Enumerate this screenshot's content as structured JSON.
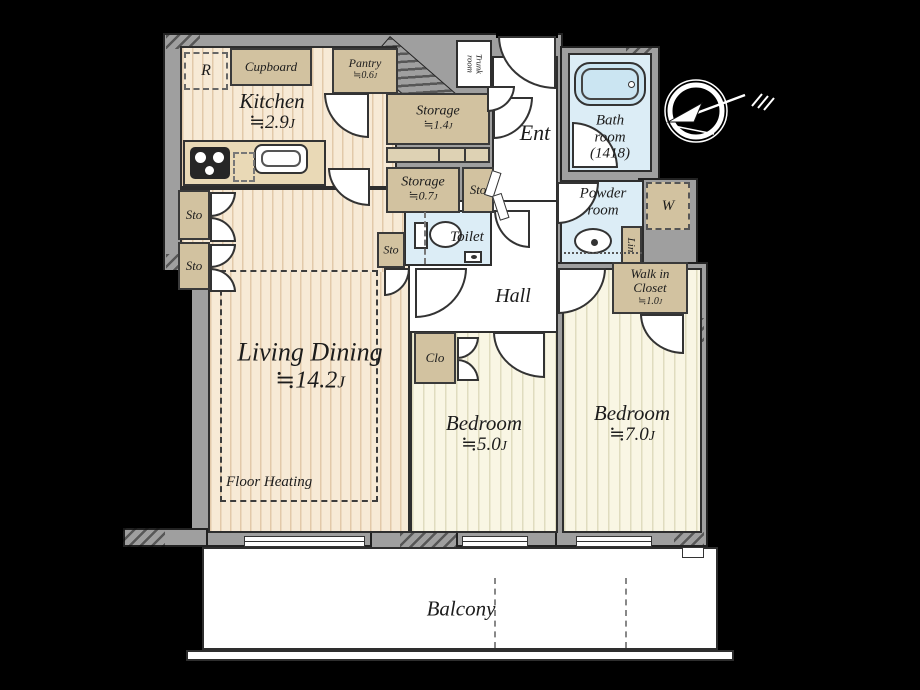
{
  "colors": {
    "background": "#000000",
    "wall": "#9f9f9f",
    "floor_warm": "#f7ead6",
    "floor_pale": "#f9f6e4",
    "wet_blue": "#dcedf6",
    "closet_tan": "#d2c2a0",
    "outline": "#2e2e2e",
    "white": "#ffffff"
  },
  "compass": {
    "icon": "north-arrow"
  },
  "rooms": {
    "kitchen": {
      "name": "Kitchen",
      "size": "≒2.9",
      "unit": "J"
    },
    "living": {
      "name": "Living Dining",
      "size": "≒14.2",
      "unit": "J"
    },
    "bedroom5": {
      "name": "Bedroom",
      "size": "≒5.0",
      "unit": "J"
    },
    "bedroom7": {
      "name": "Bedroom",
      "size": "≒7.0",
      "unit": "J"
    },
    "balcony": {
      "name": "Balcony"
    },
    "hall": {
      "name": "Hall"
    },
    "ent": {
      "name": "Ent"
    },
    "bath": {
      "line1": "Bath",
      "line2": "room",
      "line3": "(1418)"
    },
    "powder": {
      "line1": "Powder",
      "line2": "room"
    },
    "toilet": {
      "name": "Toilet"
    },
    "storage14": {
      "name": "Storage",
      "size": "≒1.4",
      "unit": "J"
    },
    "storage07": {
      "name": "Storage",
      "size": "≒0.7",
      "unit": "J"
    },
    "pantry": {
      "name": "Pantry",
      "size": "≒0.6",
      "unit": "J"
    },
    "cupboard": {
      "name": "Cupboard"
    },
    "fridge": {
      "name": "R"
    },
    "walkin": {
      "line1": "Walk in",
      "line2": "Closet",
      "size": "≒1.0",
      "unit": "J"
    },
    "clo": {
      "name": "Clo"
    },
    "lin": {
      "name": "Lin"
    },
    "washer": {
      "name": "W"
    },
    "trunk": {
      "line1": "Trunk",
      "line2": "room"
    },
    "sto": {
      "name": "Sto"
    },
    "floor_heating": {
      "name": "Floor Heating"
    }
  }
}
